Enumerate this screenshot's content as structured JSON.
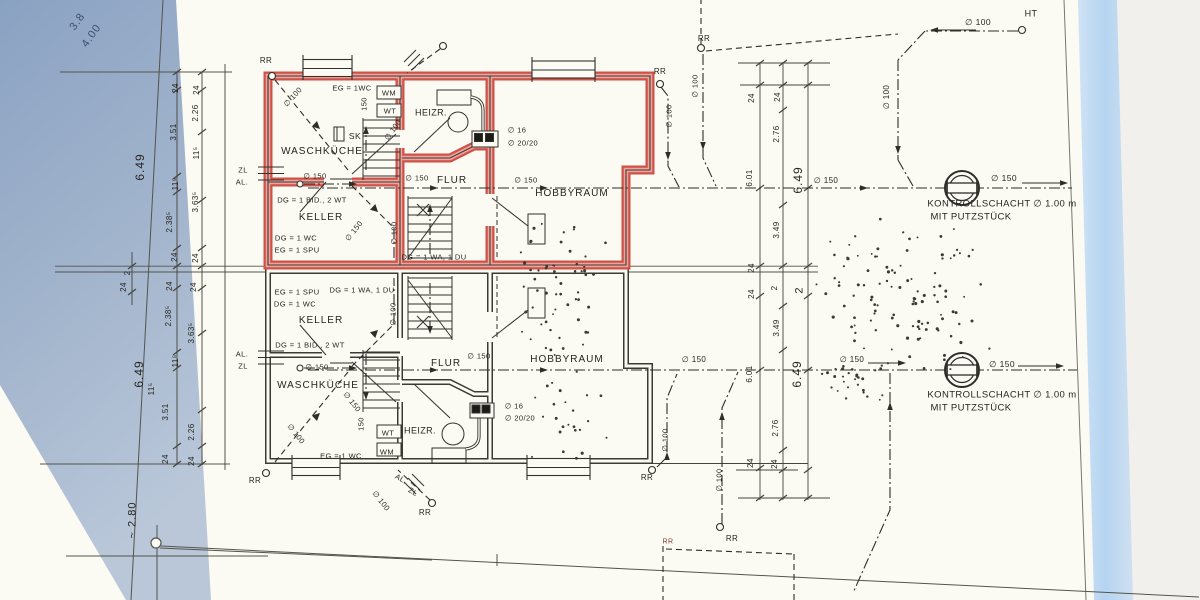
{
  "colors": {
    "paper": "#fbfaf3",
    "ink": "#2e2d29",
    "highlight_red": "#cf5148",
    "highlight_red_light": "#eea49b",
    "photo_edge_left_top": "#8aa2c2",
    "photo_edge_left_bottom": "#b9c7d9",
    "photo_edge_right": "#bed9f3",
    "pencil_blue": "#3d4f74"
  },
  "labels": [
    {
      "name": "handwritten-dim",
      "text": "3.8",
      "x": 78,
      "y": 22,
      "rot": -55,
      "size": 11,
      "color": "#3d4f74"
    },
    {
      "name": "handwritten-dim",
      "text": "4.00",
      "x": 92,
      "y": 36,
      "rot": -55,
      "size": 11,
      "color": "#3d4f74"
    },
    {
      "name": "dim-left",
      "text": "24",
      "x": 176,
      "y": 88,
      "rot": -90,
      "size": 8
    },
    {
      "name": "dim-left",
      "text": "24",
      "x": 197,
      "y": 90,
      "rot": -90,
      "size": 8
    },
    {
      "name": "dim-left",
      "text": "2.26",
      "x": 196,
      "y": 113,
      "rot": -90,
      "size": 8
    },
    {
      "name": "dim-left",
      "text": "3.51",
      "x": 174,
      "y": 132,
      "rot": -90,
      "size": 8
    },
    {
      "name": "dim-left",
      "text": "11⁵",
      "x": 197,
      "y": 153,
      "rot": -90,
      "size": 8
    },
    {
      "name": "dim-left-total",
      "text": "6.49",
      "x": 140,
      "y": 167,
      "rot": -90,
      "size": 12
    },
    {
      "name": "dim-left",
      "text": "11⁵",
      "x": 176,
      "y": 184,
      "rot": -90,
      "size": 8
    },
    {
      "name": "dim-left",
      "text": "3.63⁵",
      "x": 196,
      "y": 202,
      "rot": -90,
      "size": 8
    },
    {
      "name": "dim-left",
      "text": "2.38⁵",
      "x": 170,
      "y": 222,
      "rot": -90,
      "size": 8
    },
    {
      "name": "dim-left",
      "text": "24",
      "x": 175,
      "y": 257,
      "rot": -90,
      "size": 8
    },
    {
      "name": "dim-left",
      "text": "24",
      "x": 196,
      "y": 258,
      "rot": -90,
      "size": 8
    },
    {
      "name": "dim-left",
      "text": "2",
      "x": 128,
      "y": 273,
      "rot": -90,
      "size": 8
    },
    {
      "name": "dim-left",
      "text": "24",
      "x": 124,
      "y": 287,
      "rot": -90,
      "size": 8
    },
    {
      "name": "dim-left",
      "text": "24",
      "x": 170,
      "y": 286,
      "rot": -90,
      "size": 8
    },
    {
      "name": "dim-left",
      "text": "24",
      "x": 194,
      "y": 287,
      "rot": -90,
      "size": 8
    },
    {
      "name": "dim-left",
      "text": "2.38⁵",
      "x": 169,
      "y": 316,
      "rot": -90,
      "size": 8
    },
    {
      "name": "dim-left",
      "text": "3.63⁵",
      "x": 192,
      "y": 333,
      "rot": -90,
      "size": 8
    },
    {
      "name": "dim-left",
      "text": "11⁵",
      "x": 176,
      "y": 361,
      "rot": -90,
      "size": 8
    },
    {
      "name": "dim-left-total",
      "text": "6.49",
      "x": 139,
      "y": 374,
      "rot": -90,
      "size": 12
    },
    {
      "name": "dim-left",
      "text": "11⁵",
      "x": 152,
      "y": 389,
      "rot": -90,
      "size": 8
    },
    {
      "name": "dim-left",
      "text": "3.51",
      "x": 166,
      "y": 412,
      "rot": -90,
      "size": 8
    },
    {
      "name": "dim-left",
      "text": "2.26",
      "x": 192,
      "y": 432,
      "rot": -90,
      "size": 8
    },
    {
      "name": "dim-left",
      "text": "24",
      "x": 166,
      "y": 459,
      "rot": -90,
      "size": 8
    },
    {
      "name": "dim-left",
      "text": "24",
      "x": 192,
      "y": 461,
      "rot": -90,
      "size": 8
    },
    {
      "name": "dim-left-approx",
      "text": "~ 2.80",
      "x": 133,
      "y": 520,
      "rot": -90,
      "size": 11
    },
    {
      "name": "dim-mid",
      "text": "24",
      "x": 752,
      "y": 98,
      "rot": -90,
      "size": 8
    },
    {
      "name": "dim-mid",
      "text": "24",
      "x": 778,
      "y": 97,
      "rot": -90,
      "size": 8
    },
    {
      "name": "dim-mid",
      "text": "2.76",
      "x": 777,
      "y": 134,
      "rot": -90,
      "size": 8
    },
    {
      "name": "dim-mid",
      "text": "6.01",
      "x": 750,
      "y": 178,
      "rot": -90,
      "size": 8
    },
    {
      "name": "dim-mid-total",
      "text": "6.49",
      "x": 798,
      "y": 180,
      "rot": -90,
      "size": 12
    },
    {
      "name": "dim-mid",
      "text": "3.49",
      "x": 777,
      "y": 230,
      "rot": -90,
      "size": 8
    },
    {
      "name": "dim-mid",
      "text": "24",
      "x": 752,
      "y": 268,
      "rot": -90,
      "size": 8
    },
    {
      "name": "dim-mid",
      "text": "2",
      "x": 775,
      "y": 288,
      "rot": -90,
      "size": 8
    },
    {
      "name": "dim-mid",
      "text": "2",
      "x": 800,
      "y": 290,
      "rot": -90,
      "size": 11
    },
    {
      "name": "dim-mid",
      "text": "24",
      "x": 752,
      "y": 294,
      "rot": -90,
      "size": 8
    },
    {
      "name": "dim-mid",
      "text": "3.49",
      "x": 777,
      "y": 328,
      "rot": -90,
      "size": 8
    },
    {
      "name": "dim-mid",
      "text": "6.01",
      "x": 750,
      "y": 374,
      "rot": -90,
      "size": 8
    },
    {
      "name": "dim-mid-total",
      "text": "6.49",
      "x": 797,
      "y": 374,
      "rot": -90,
      "size": 12
    },
    {
      "name": "dim-mid",
      "text": "2.76",
      "x": 776,
      "y": 428,
      "rot": -90,
      "size": 8
    },
    {
      "name": "dim-mid",
      "text": "24",
      "x": 751,
      "y": 463,
      "rot": -90,
      "size": 8
    },
    {
      "name": "dim-mid",
      "text": "24",
      "x": 775,
      "y": 464,
      "rot": -90,
      "size": 8
    },
    {
      "name": "rr-label",
      "text": "RR",
      "x": 266,
      "y": 61,
      "rot": 0,
      "size": 8
    },
    {
      "name": "pipe-label",
      "text": "∅ 100",
      "x": 293,
      "y": 97,
      "rot": -48,
      "size": 7.5
    },
    {
      "name": "fixture-note",
      "text": "EG = 1WC",
      "x": 352,
      "y": 88,
      "rot": 0,
      "size": 7.5
    },
    {
      "name": "pipe-label",
      "text": "150",
      "x": 364,
      "y": 104,
      "rot": -90,
      "size": 7.5
    },
    {
      "name": "appliance-label",
      "text": "WM",
      "x": 389,
      "y": 93,
      "rot": 0,
      "size": 7.5
    },
    {
      "name": "appliance-label",
      "text": "WT",
      "x": 390,
      "y": 111,
      "rot": 0,
      "size": 7.5
    },
    {
      "name": "pipe-label",
      "text": "∅ 100",
      "x": 393,
      "y": 130,
      "rot": -55,
      "size": 7.5
    },
    {
      "name": "fixture-label",
      "text": "SK",
      "x": 355,
      "y": 136,
      "rot": 0,
      "size": 8.5
    },
    {
      "name": "room-label",
      "text": "WASCHKÜCHE",
      "x": 322,
      "y": 152,
      "rot": 0,
      "size": 10
    },
    {
      "name": "pipe-label",
      "text": "ZL",
      "x": 243,
      "y": 170,
      "rot": 0,
      "size": 7.5
    },
    {
      "name": "pipe-label",
      "text": "AL.",
      "x": 242,
      "y": 182,
      "rot": 0,
      "size": 7.5
    },
    {
      "name": "pipe-label",
      "text": "∅ 150",
      "x": 315,
      "y": 176,
      "rot": 0,
      "size": 7.5
    },
    {
      "name": "fixture-note",
      "text": "DG = 1 BID., 2 WT",
      "x": 312,
      "y": 200,
      "rot": 0,
      "size": 7.5
    },
    {
      "name": "room-label",
      "text": "KELLER",
      "x": 321,
      "y": 218,
      "rot": 0,
      "size": 10
    },
    {
      "name": "fixture-note",
      "text": "DG = 1 WC",
      "x": 296,
      "y": 238,
      "rot": 0,
      "size": 7.5
    },
    {
      "name": "fixture-note",
      "text": "EG = 1 SPU",
      "x": 297,
      "y": 250,
      "rot": 0,
      "size": 7.5
    },
    {
      "name": "pipe-label",
      "text": "∅ 150",
      "x": 354,
      "y": 231,
      "rot": -52,
      "size": 7.5
    },
    {
      "name": "pipe-label",
      "text": "∅ 100",
      "x": 394,
      "y": 233,
      "rot": -90,
      "size": 7.5
    },
    {
      "name": "room-label",
      "text": "HEIZR.",
      "x": 431,
      "y": 113,
      "rot": 0,
      "size": 9
    },
    {
      "name": "flue-label",
      "text": "∅ 16",
      "x": 517,
      "y": 130,
      "rot": 0,
      "size": 7.5
    },
    {
      "name": "flue-label",
      "text": "∅ 20/20",
      "x": 523,
      "y": 143,
      "rot": 0,
      "size": 7.5
    },
    {
      "name": "pipe-label",
      "text": "∅ 150",
      "x": 417,
      "y": 178,
      "rot": 0,
      "size": 7.5
    },
    {
      "name": "room-label",
      "text": "FLUR",
      "x": 452,
      "y": 181,
      "rot": 0,
      "size": 10
    },
    {
      "name": "pipe-label",
      "text": "∅ 150",
      "x": 526,
      "y": 180,
      "rot": 0,
      "size": 7.5
    },
    {
      "name": "room-label",
      "text": "HOBBYRAUM",
      "x": 572,
      "y": 194,
      "rot": 0,
      "size": 10
    },
    {
      "name": "fixture-note",
      "text": "DG = 1 WA, 1 DU",
      "x": 434,
      "y": 257,
      "rot": 0,
      "size": 7.5
    },
    {
      "name": "rr-label",
      "text": "RR",
      "x": 660,
      "y": 72,
      "rot": 0,
      "size": 8
    },
    {
      "name": "pipe-label",
      "text": "∅ 100",
      "x": 669,
      "y": 116,
      "rot": -90,
      "size": 7.5
    },
    {
      "name": "pipe-label",
      "text": "∅ 100",
      "x": 695,
      "y": 86,
      "rot": -90,
      "size": 7.5
    },
    {
      "name": "rr-label",
      "text": "RR",
      "x": 704,
      "y": 39,
      "rot": 0,
      "size": 8
    },
    {
      "name": "pipe-label",
      "text": "∅ 100",
      "x": 978,
      "y": 22,
      "rot": 0,
      "size": 8.5
    },
    {
      "name": "site-label",
      "text": "HT",
      "x": 1031,
      "y": 14,
      "rot": 0,
      "size": 9
    },
    {
      "name": "pipe-label",
      "text": "∅ 100",
      "x": 887,
      "y": 97,
      "rot": -90,
      "size": 8
    },
    {
      "name": "pipe-label",
      "text": "∅ 150",
      "x": 1004,
      "y": 178,
      "rot": 0,
      "size": 8.5
    },
    {
      "name": "pipe-label",
      "text": "∅ 150",
      "x": 826,
      "y": 181,
      "rot": 0,
      "size": 8
    },
    {
      "name": "shaft-caption-line1",
      "text": "KONTROLLSCHACHT ∅ 1.00 m",
      "x": 1002,
      "y": 204,
      "rot": 0,
      "size": 9.5
    },
    {
      "name": "shaft-caption-line2",
      "text": "MIT PUTZSTÜCK",
      "x": 971,
      "y": 217,
      "rot": 0,
      "size": 9.5
    },
    {
      "name": "fixture-note",
      "text": "EG = 1 SPU",
      "x": 297,
      "y": 292,
      "rot": 0,
      "size": 7.5
    },
    {
      "name": "fixture-note",
      "text": "DG = 1 WA, 1 DU",
      "x": 362,
      "y": 290,
      "rot": 0,
      "size": 7.5
    },
    {
      "name": "fixture-note",
      "text": "DG = 1 WC",
      "x": 295,
      "y": 304,
      "rot": 0,
      "size": 7.5
    },
    {
      "name": "room-label",
      "text": "KELLER",
      "x": 321,
      "y": 321,
      "rot": 0,
      "size": 10
    },
    {
      "name": "fixture-note",
      "text": "DG = 1 BID , 2 WT",
      "x": 310,
      "y": 345,
      "rot": 0,
      "size": 7.5
    },
    {
      "name": "pipe-label",
      "text": "∅ 150",
      "x": 317,
      "y": 367,
      "rot": 0,
      "size": 7.5
    },
    {
      "name": "room-label",
      "text": "WASCHKÜCHE",
      "x": 318,
      "y": 386,
      "rot": 0,
      "size": 10
    },
    {
      "name": "pipe-label",
      "text": "∅ 150",
      "x": 352,
      "y": 402,
      "rot": 52,
      "size": 7.5
    },
    {
      "name": "pipe-label",
      "text": "∅ 100",
      "x": 393,
      "y": 314,
      "rot": -90,
      "size": 7.5
    },
    {
      "name": "room-label",
      "text": "FLUR",
      "x": 446,
      "y": 364,
      "rot": 0,
      "size": 10
    },
    {
      "name": "pipe-label",
      "text": "∅ 150",
      "x": 479,
      "y": 356,
      "rot": 0,
      "size": 7.5
    },
    {
      "name": "room-label",
      "text": "HOBBYRAUM",
      "x": 567,
      "y": 360,
      "rot": 0,
      "size": 10
    },
    {
      "name": "flue-label",
      "text": "∅ 16",
      "x": 514,
      "y": 406,
      "rot": 0,
      "size": 7.5
    },
    {
      "name": "flue-label",
      "text": "∅ 20/20",
      "x": 520,
      "y": 418,
      "rot": 0,
      "size": 7.5
    },
    {
      "name": "room-label",
      "text": "HEIZR.",
      "x": 420,
      "y": 431,
      "rot": 0,
      "size": 9
    },
    {
      "name": "appliance-label",
      "text": "WT",
      "x": 388,
      "y": 433,
      "rot": 0,
      "size": 7.5
    },
    {
      "name": "appliance-label",
      "text": "WM",
      "x": 387,
      "y": 452,
      "rot": 0,
      "size": 7.5
    },
    {
      "name": "fixture-note",
      "text": "EG = 1 WC",
      "x": 341,
      "y": 456,
      "rot": 0,
      "size": 7.5
    },
    {
      "name": "pipe-label",
      "text": "∅ 100",
      "x": 296,
      "y": 434,
      "rot": 52,
      "size": 7.5
    },
    {
      "name": "pipe-label",
      "text": "150",
      "x": 361,
      "y": 424,
      "rot": -90,
      "size": 7.5
    },
    {
      "name": "pipe-label",
      "text": "AL.",
      "x": 242,
      "y": 354,
      "rot": 0,
      "size": 7.5
    },
    {
      "name": "pipe-label",
      "text": "ZL",
      "x": 243,
      "y": 366,
      "rot": 0,
      "size": 7.5
    },
    {
      "name": "rr-label",
      "text": "RR",
      "x": 255,
      "y": 481,
      "rot": 0,
      "size": 8
    },
    {
      "name": "pipe-label",
      "text": "AL.",
      "x": 401,
      "y": 479,
      "rot": 30,
      "size": 7.5
    },
    {
      "name": "pipe-label",
      "text": "ZL",
      "x": 413,
      "y": 492,
      "rot": 30,
      "size": 7.5
    },
    {
      "name": "pipe-label",
      "text": "∅ 100",
      "x": 381,
      "y": 501,
      "rot": 52,
      "size": 7.5
    },
    {
      "name": "rr-label",
      "text": "RR",
      "x": 425,
      "y": 513,
      "rot": 0,
      "size": 8
    },
    {
      "name": "rr-label",
      "text": "RR",
      "x": 647,
      "y": 478,
      "rot": 0,
      "size": 8
    },
    {
      "name": "pipe-label",
      "text": "∅ 100",
      "x": 665,
      "y": 440,
      "rot": -90,
      "size": 7.5
    },
    {
      "name": "rr-label",
      "text": "RR",
      "x": 668,
      "y": 542,
      "rot": 0,
      "size": 7,
      "color": "#7a4038"
    },
    {
      "name": "rr-label",
      "text": "RR",
      "x": 732,
      "y": 539,
      "rot": 0,
      "size": 8
    },
    {
      "name": "pipe-label",
      "text": "∅ 100",
      "x": 719,
      "y": 480,
      "rot": -90,
      "size": 7.5
    },
    {
      "name": "pipe-label",
      "text": "∅ 150",
      "x": 694,
      "y": 360,
      "rot": 0,
      "size": 8
    },
    {
      "name": "pipe-label",
      "text": "∅ 150",
      "x": 852,
      "y": 360,
      "rot": 0,
      "size": 8
    },
    {
      "name": "pipe-label",
      "text": "∅ 150",
      "x": 1002,
      "y": 364,
      "rot": 0,
      "size": 8.5
    },
    {
      "name": "shaft-caption-line1",
      "text": "KONTROLLSCHACHT ∅ 1.00 m",
      "x": 1002,
      "y": 395,
      "rot": 0,
      "size": 9.5
    },
    {
      "name": "shaft-caption-line2",
      "text": "MIT PUTZSTÜCK",
      "x": 971,
      "y": 408,
      "rot": 0,
      "size": 9.5
    }
  ]
}
